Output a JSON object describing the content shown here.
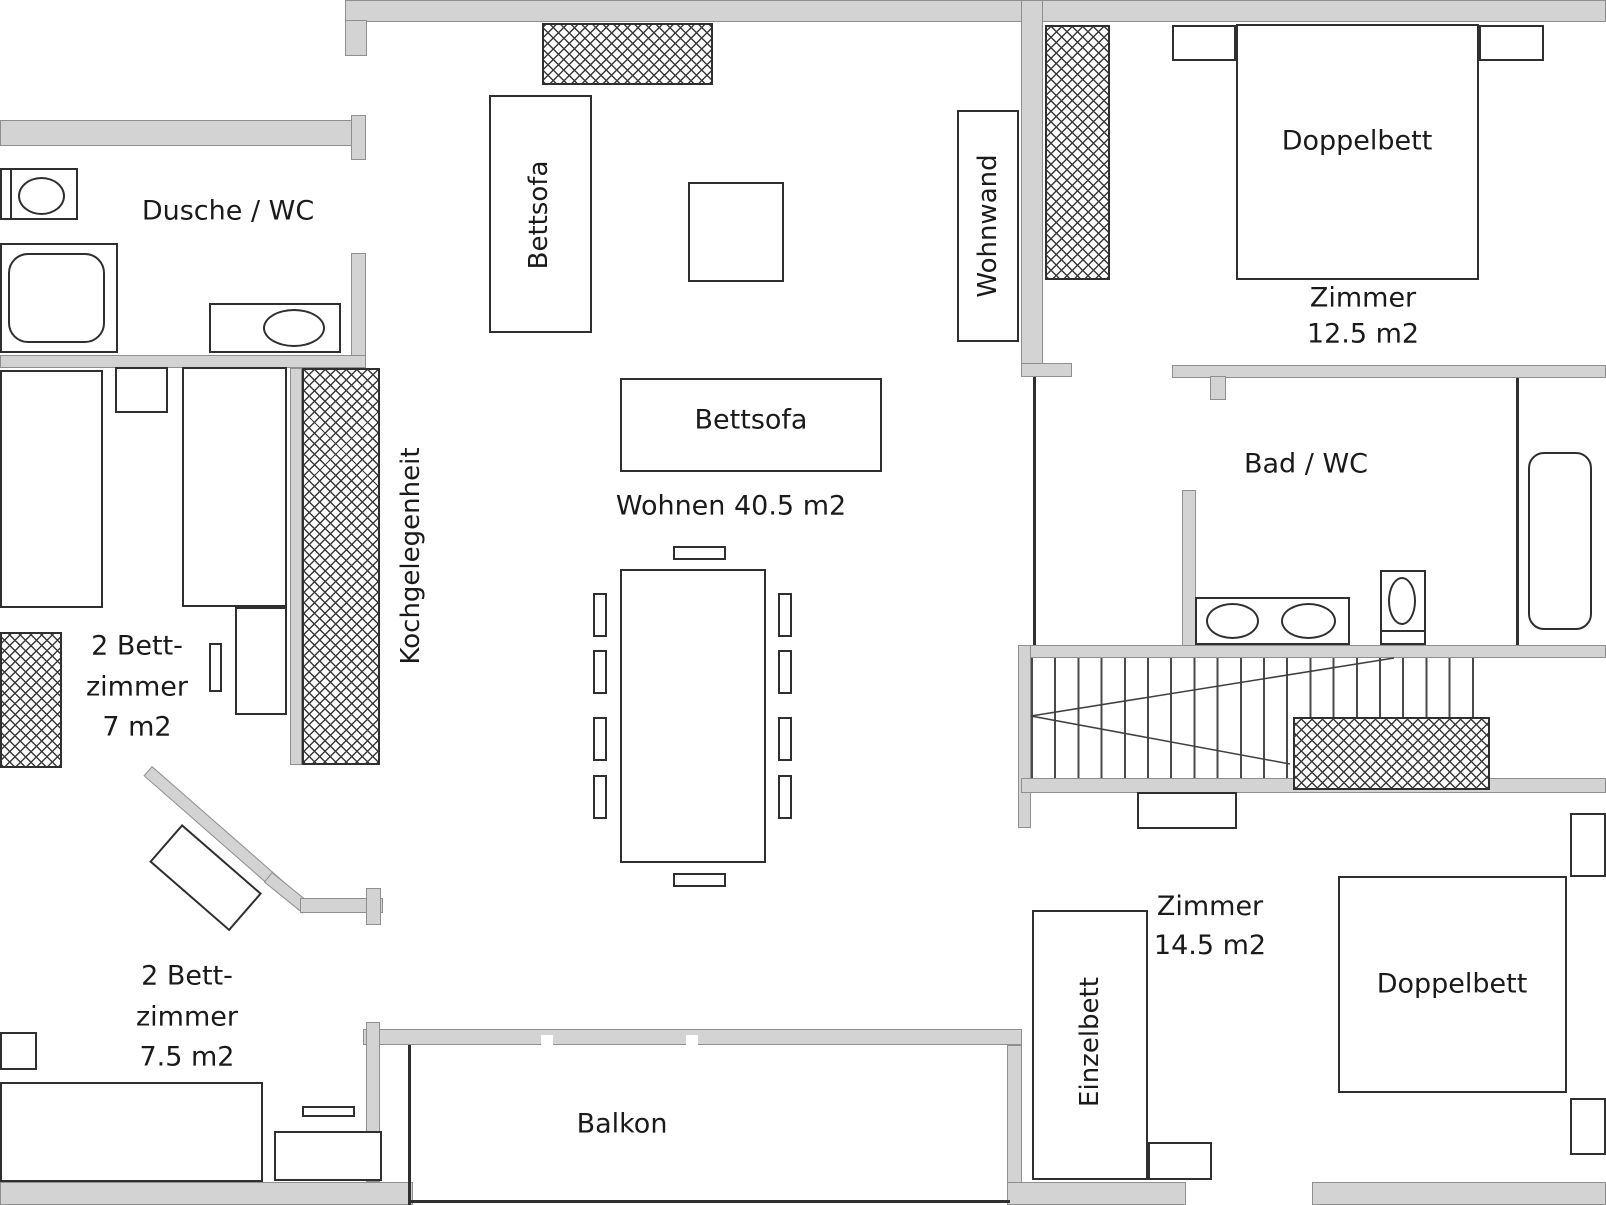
{
  "colors": {
    "wall_fill": "#d3d3d3",
    "wall_edge": "#8f8f8f",
    "furniture_outline": "#2f2f2f",
    "text": "#1a1a1a",
    "background": "#ffffff"
  },
  "rooms": {
    "dusche_wc": "Dusche / WC",
    "bettzimmer_7": [
      "2 Bett-",
      "zimmer",
      "7 m2"
    ],
    "bettzimmer_75": [
      "2 Bett-",
      "zimmer",
      "7.5 m2"
    ],
    "wohnen": "Wohnen 40.5 m2",
    "zimmer_125": [
      "Zimmer",
      "12.5 m2"
    ],
    "zimmer_145": [
      "Zimmer",
      "14.5 m2"
    ],
    "bad_wc": "Bad / WC",
    "balkon": "Balkon"
  },
  "furniture": {
    "bettsofa_wall": "Bettsofa",
    "bettsofa_center": "Bettsofa",
    "wohnwand": "Wohnwand",
    "kochgelegenheit": "Kochgelegenheit",
    "doppelbett_125": "Doppelbett",
    "doppelbett_145": "Doppelbett",
    "einzelbett": "Einzelbett"
  }
}
